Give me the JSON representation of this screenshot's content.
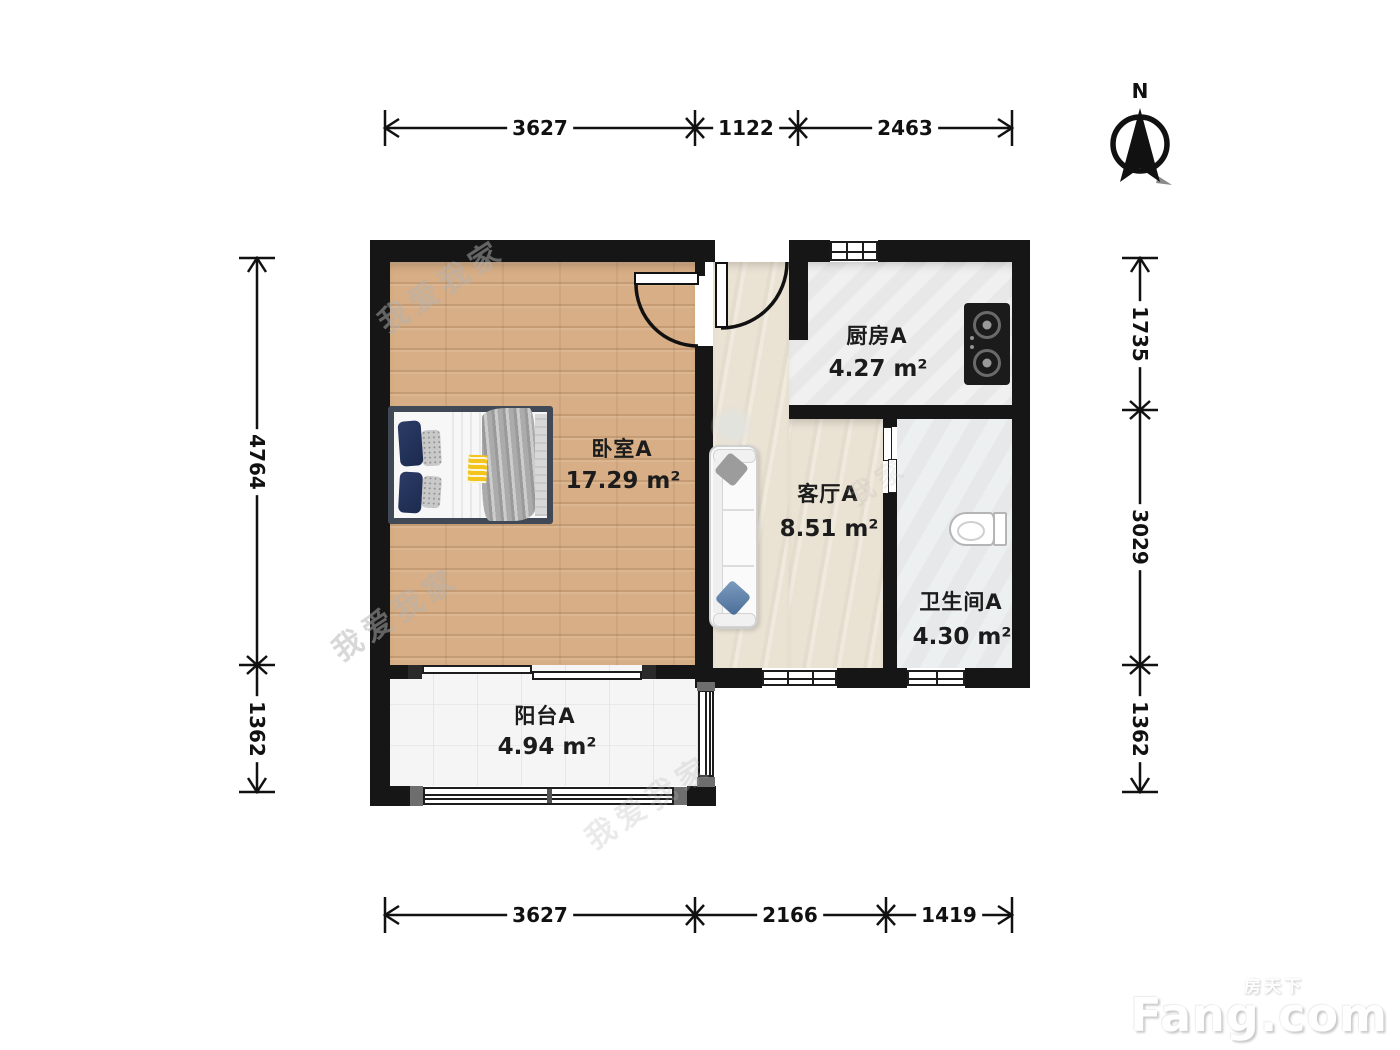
{
  "compass": {
    "label": "N"
  },
  "rooms": {
    "bedroom": {
      "name": "卧室A",
      "area": "17.29 m²"
    },
    "kitchen": {
      "name": "厨房A",
      "area": "4.27 m²"
    },
    "living": {
      "name": "客厅A",
      "area": "8.51 m²"
    },
    "bathroom": {
      "name": "卫生间A",
      "area": "4.30 m²"
    },
    "balcony": {
      "name": "阳台A",
      "area": "4.94 m²"
    }
  },
  "dimensions": {
    "top": [
      "3627",
      "1122",
      "2463"
    ],
    "bottom": [
      "3627",
      "2166",
      "1419"
    ],
    "left": [
      "4764",
      "1362"
    ],
    "right": [
      "1735",
      "3029",
      "1362"
    ]
  },
  "watermark": {
    "brand": "我爱我家",
    "short": "我家"
  },
  "logo": {
    "cn": "房天下",
    "en": "Fang.com"
  }
}
